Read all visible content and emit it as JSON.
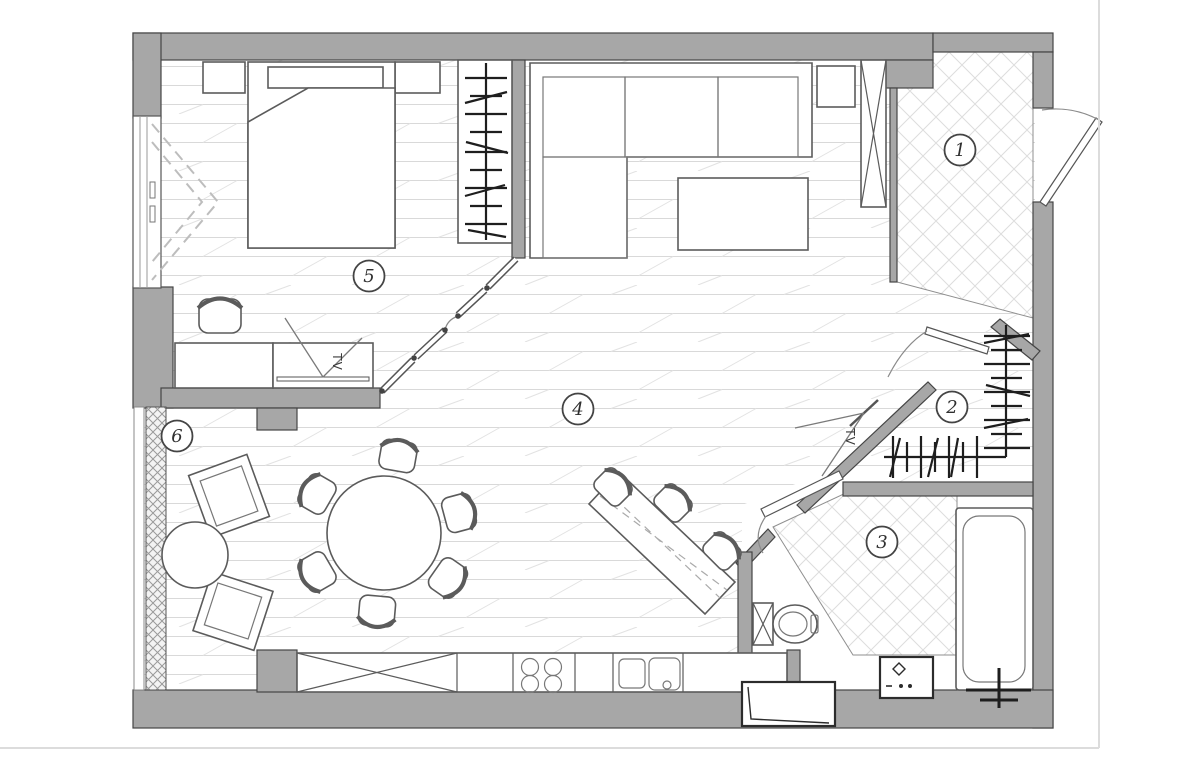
{
  "plan": {
    "rooms": [
      {
        "number": "1"
      },
      {
        "number": "2"
      },
      {
        "number": "3"
      },
      {
        "number": "4"
      },
      {
        "number": "5"
      },
      {
        "number": "6"
      }
    ],
    "labels": {
      "tv_bedroom": "TV",
      "tv_living": "TV"
    },
    "colors": {
      "wall_fill": "#a7a7a7",
      "wall_outline": "#454545",
      "wood_floor_line": "#d9d9d9",
      "tile_line": "#dddddd",
      "furniture_line": "#5b5b5b",
      "detail_dark": "#1e1e1e",
      "page_background": "#ffffff"
    }
  }
}
